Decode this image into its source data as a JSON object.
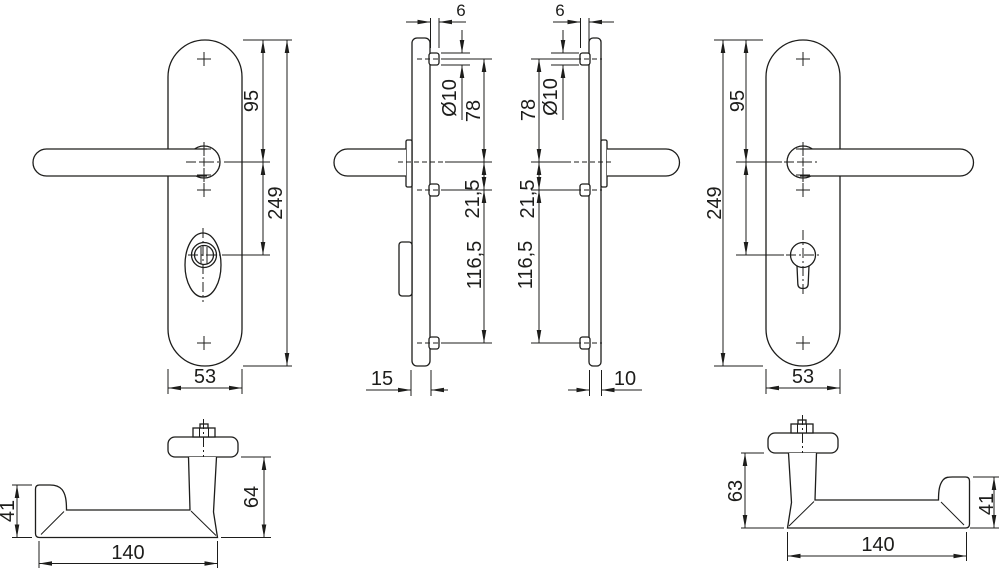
{
  "drawing": {
    "type": "door-handle-security-plate-technical-drawing",
    "line_color": "#1d1d1b",
    "background_color": "#ffffff",
    "views": {
      "plate_front_left": {
        "total_height": "249",
        "top_to_handle_center": "95",
        "plate_width": "53"
      },
      "plate_profile_left": {
        "pin_protrusion": "6",
        "pin_diameter": "Ø10",
        "top_screw_to_handle": "78",
        "handle_to_screw": "21,5",
        "screw_to_screw": "116,5",
        "plate_depth": "15"
      },
      "plate_profile_right": {
        "pin_protrusion": "6",
        "pin_diameter": "Ø10",
        "top_screw_to_handle": "78",
        "handle_to_screw": "21,5",
        "screw_to_screw": "116,5",
        "plate_depth": "10"
      },
      "plate_front_right": {
        "total_height": "249",
        "top_to_handle_center": "95",
        "plate_width": "53"
      },
      "lever_left": {
        "grip_height": "41",
        "lever_length": "140",
        "total_height": "64"
      },
      "lever_right": {
        "total_height": "63",
        "lever_length": "140",
        "grip_height": "41"
      }
    }
  }
}
